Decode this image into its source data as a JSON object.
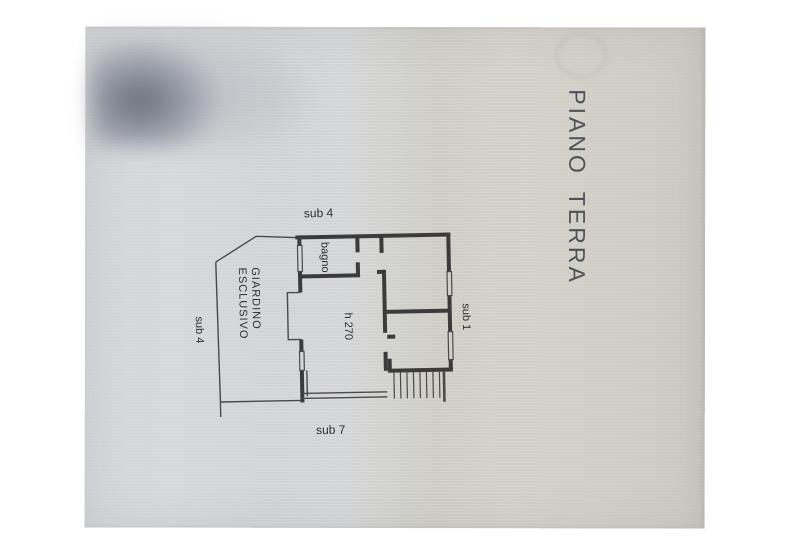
{
  "document": {
    "title": "PIANO TERRA",
    "plan_labels": {
      "sub4_top": "sub 4",
      "sub4_left": "sub 4",
      "sub1_right": "sub 1",
      "sub7_bottom": "sub 7",
      "bagno": "bagno",
      "room_height": "h 270",
      "garden_line1": "GIARDINO",
      "garden_line2": "ESCLUSIVO"
    },
    "colors": {
      "ink": "#3b3b3b",
      "ink_thin": "#4a4a4a",
      "paper_cool": "#d8dade",
      "paper_warm": "#d3d1c8",
      "background": "#ffffff"
    }
  }
}
